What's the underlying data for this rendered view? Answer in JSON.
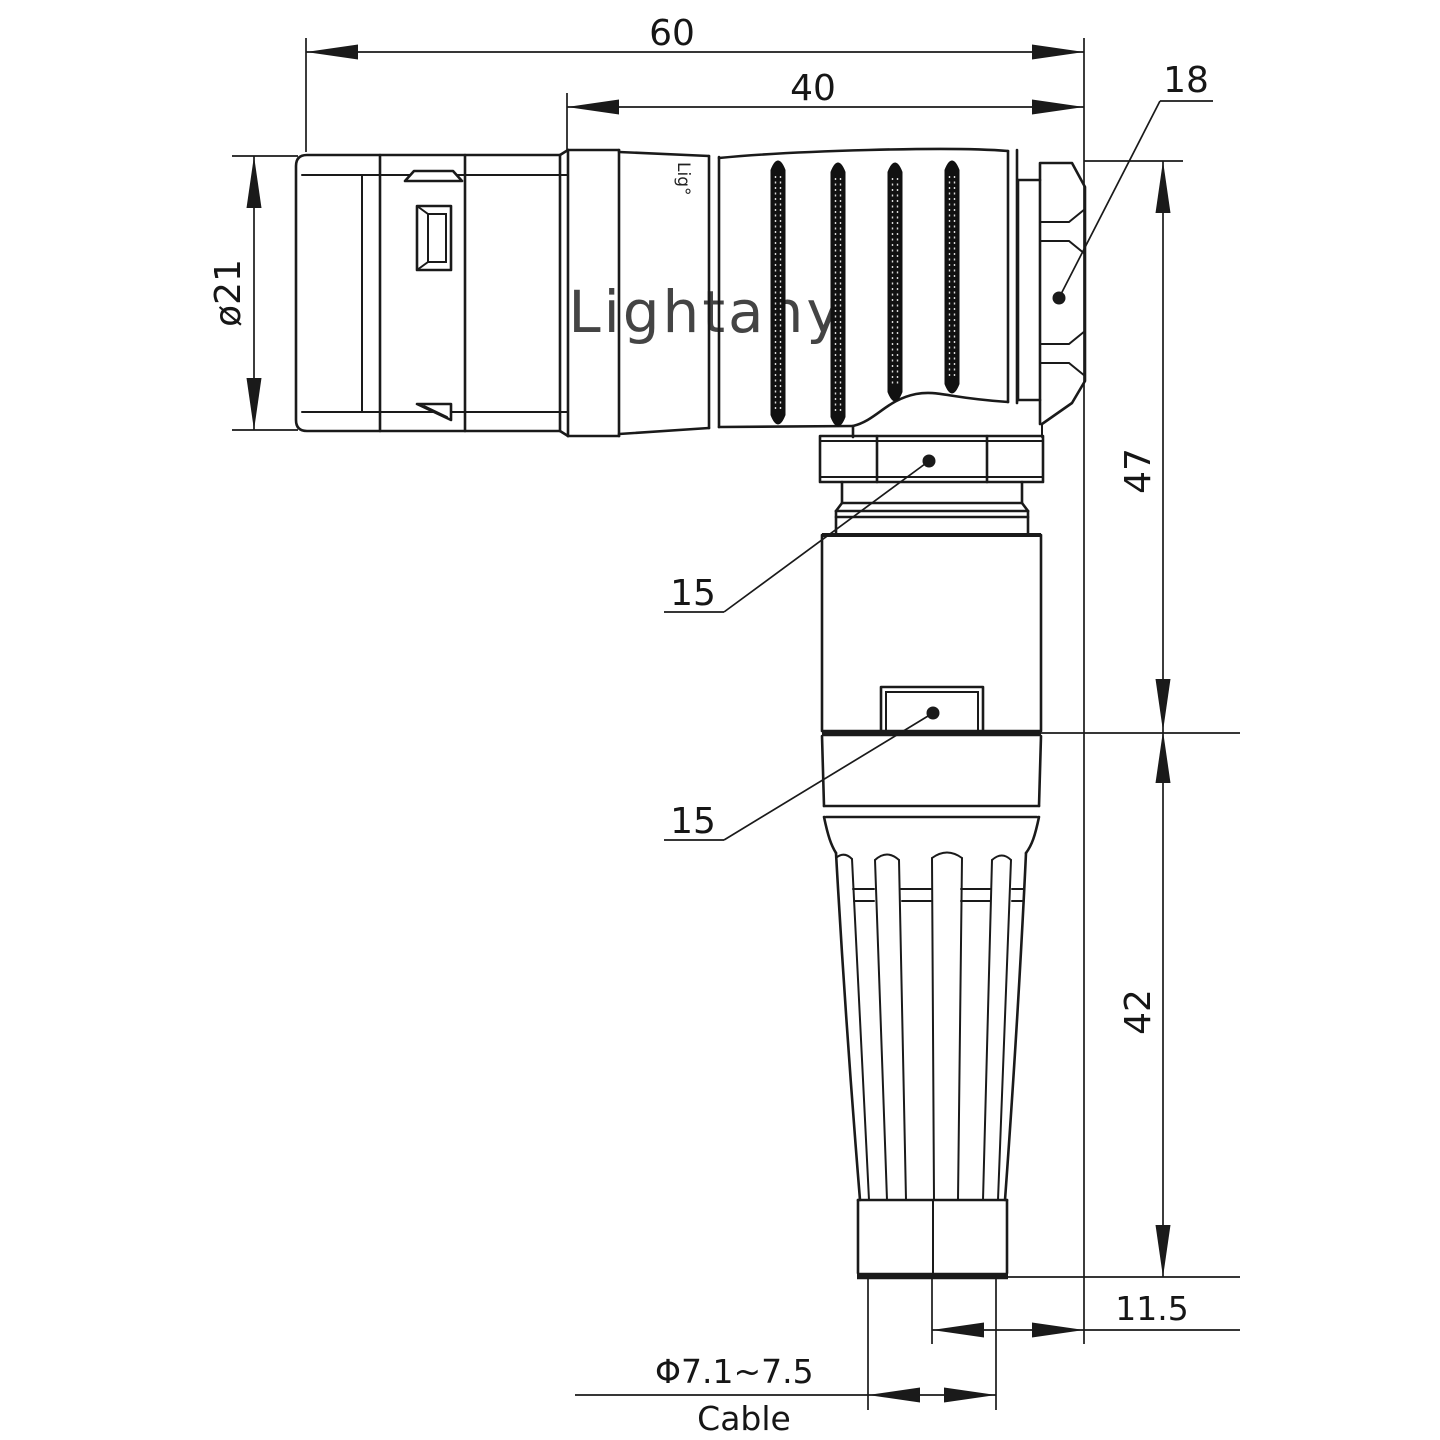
{
  "drawing": {
    "background": "#ffffff",
    "line_color": "#1a1a1a",
    "watermark": {
      "text": "Lightany",
      "color": "#f2c6c6"
    },
    "brand_mark": "Lig°",
    "dims": {
      "overall_length": "60",
      "rear_section_length": "40",
      "nut_across_flats": "18",
      "shell_diameter": "ø21",
      "upper_hex_size": "15",
      "lower_hex_size": "15",
      "height_to_shoulder": "47",
      "strain_relief_length": "42",
      "cable_axis_offset": "11.5",
      "cable_diameter_range": "Φ7.1~7.5",
      "cable_word": "Cable"
    }
  }
}
